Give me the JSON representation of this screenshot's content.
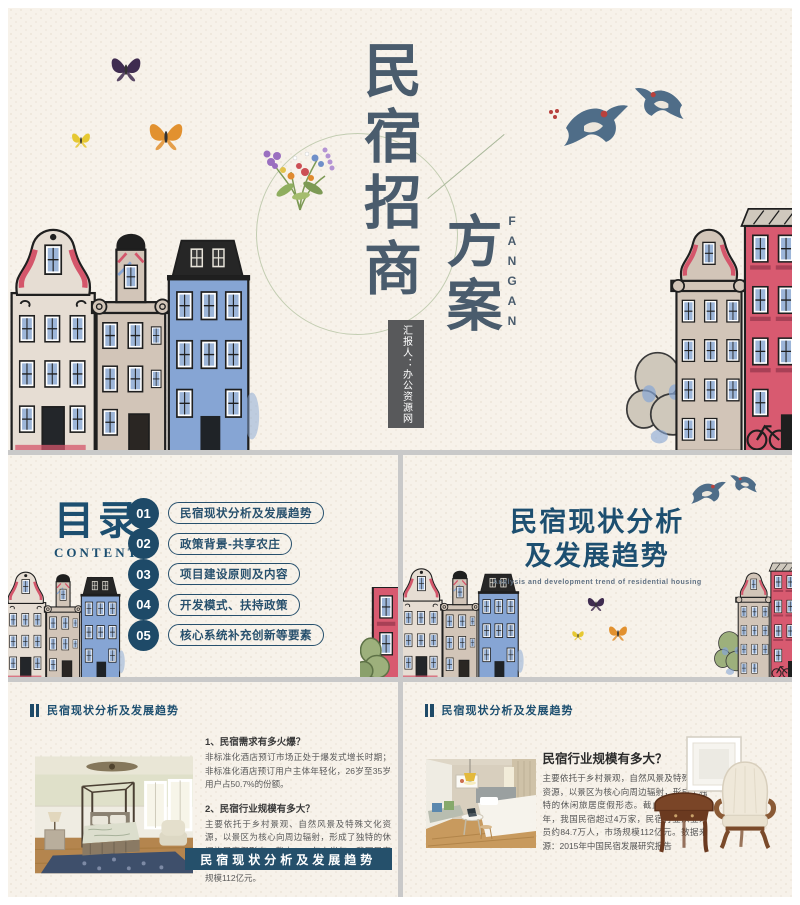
{
  "slides": {
    "cover": {
      "title_vertical": "民宿招商",
      "title_vertical_2": "方案",
      "title_latin": "FANGAN",
      "presenter": "汇报人：办公资源网"
    },
    "contents": {
      "title": "目录",
      "subtitle": "CONTENTS",
      "items": [
        {
          "num": "01",
          "label": "民宿现状分析及发展趋势"
        },
        {
          "num": "02",
          "label": "政策背景-共享农庄"
        },
        {
          "num": "03",
          "label": "项目建设原则及内容"
        },
        {
          "num": "04",
          "label": "开发模式、扶持政策"
        },
        {
          "num": "05",
          "label": "核心系统补充创新等要素"
        }
      ]
    },
    "section": {
      "title_line1": "民宿现状分析",
      "title_line2": "及发展趋势",
      "subtitle_en": "Analysis and development trend of residential housing"
    },
    "detail_left": {
      "header": "民宿现状分析及发展趋势",
      "q1_title": "1、民宿需求有多火爆？",
      "q1_body": "非标准化酒店预订市场正处于爆发式增长时期；非标准化酒店预订用户主体年轻化，26岁至35岁用户占50.7%的份额。",
      "q2_title": "2、民宿行业规模有多大？",
      "q2_body": "主要依托于乡村景观、自然风景及特殊文化资源，以景区为核心向周边辐射，形成了独特的休闲旅居度假形态。截止2015年上半年，我国民宿超过4万家，民宿行业从业人员约84.7万人，市场规模112亿元。",
      "banner": "民宿现状分析及发展趋势"
    },
    "detail_right": {
      "header": "民宿现状分析及发展趋势",
      "heading": "民宿行业规模有多大？",
      "body": "主要依托于乡村景观，自然风景及特殊文化资源，以景区为核心向周边辐射，形成了独特的休闲旅居度假形态。截止2015年上半年，我国民宿超过4万家，民宿行业从业人员约84.7万人，市场规模112亿元。数据来源：2015年中国民宿发展研究报告"
    }
  },
  "colors": {
    "accent": "#1d4f70",
    "cover_title": "#4a5c6d",
    "banner_bg": "#25506b",
    "number_circle": "#1e4a68",
    "presenter_box": "#58595b",
    "house_red": "#d85a70",
    "house_blue": "#86a5d4",
    "slide_background": "#f7f2ea"
  }
}
